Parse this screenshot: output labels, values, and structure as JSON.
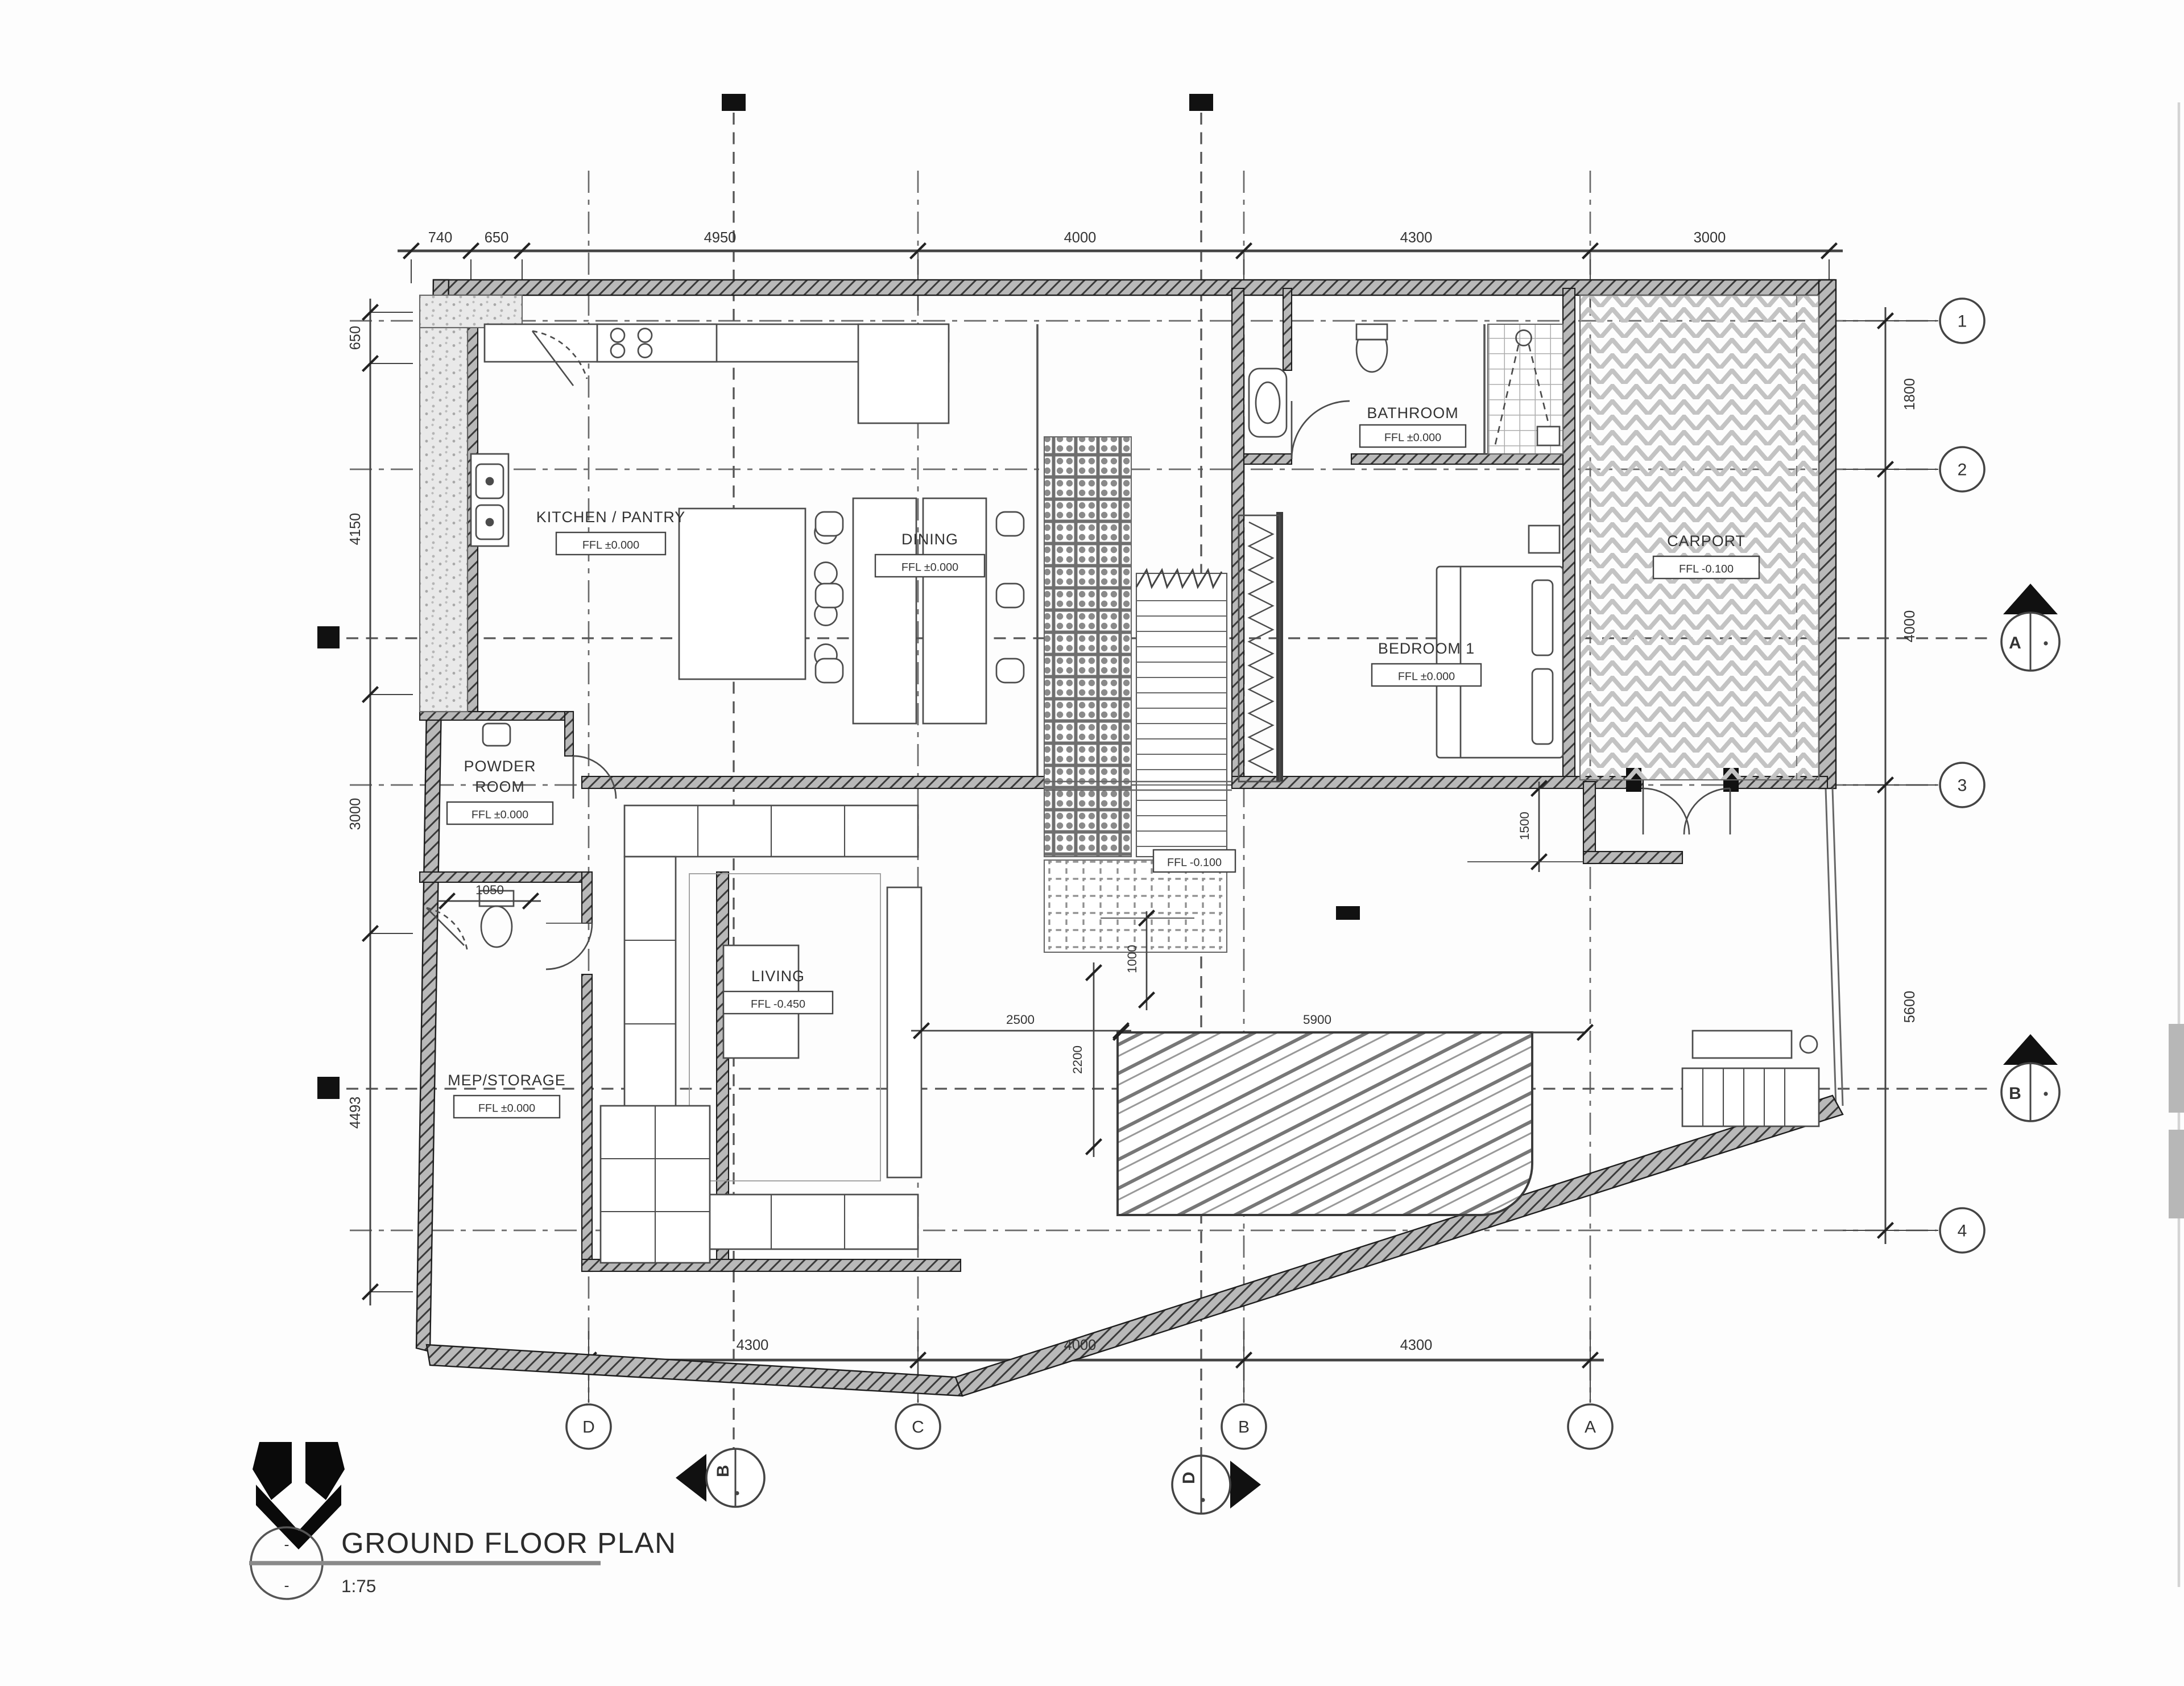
{
  "drawing": {
    "title": "GROUND FLOOR PLAN",
    "scale": "1:75",
    "ref_top": "-",
    "ref_bottom": "-"
  },
  "rooms": {
    "kitchen": {
      "name": "KITCHEN / PANTRY",
      "ffl": "FFL ±0.000"
    },
    "dining": {
      "name": "DINING",
      "ffl": "FFL ±0.000"
    },
    "bathroom": {
      "name": "BATHROOM",
      "ffl": "FFL ±0.000"
    },
    "bedroom1": {
      "name": "BEDROOM 1",
      "ffl": "FFL ±0.000"
    },
    "carport": {
      "name": "CARPORT",
      "ffl": "FFL -0.100"
    },
    "powder": {
      "line1": "POWDER",
      "line2": "ROOM",
      "ffl": "FFL ±0.000"
    },
    "living": {
      "name": "LIVING",
      "ffl": "FFL -0.450"
    },
    "mep": {
      "name": "MEP/STORAGE",
      "ffl": "FFL ±0.000"
    },
    "entry_court": {
      "ffl": "FFL -0.100"
    }
  },
  "grid": {
    "columns": [
      "D",
      "C",
      "B",
      "A"
    ],
    "rows": [
      "1",
      "2",
      "3",
      "4"
    ]
  },
  "dims": {
    "top": [
      "740",
      "650",
      "4950",
      "4000",
      "4300",
      "3000"
    ],
    "bottom": [
      "4300",
      "4000",
      "4300"
    ],
    "left": [
      "650",
      "4150",
      "3000",
      "4493"
    ],
    "right": [
      "1800",
      "4000",
      "5600"
    ],
    "inner": {
      "foyer": "1050",
      "court_offset": "1000",
      "pool_offset": "2500",
      "pool_width": "2200",
      "pool_length": "5900",
      "entry": "1500"
    }
  },
  "sections": {
    "right": [
      "A",
      "B"
    ],
    "bottom": [
      "B",
      "D"
    ]
  }
}
